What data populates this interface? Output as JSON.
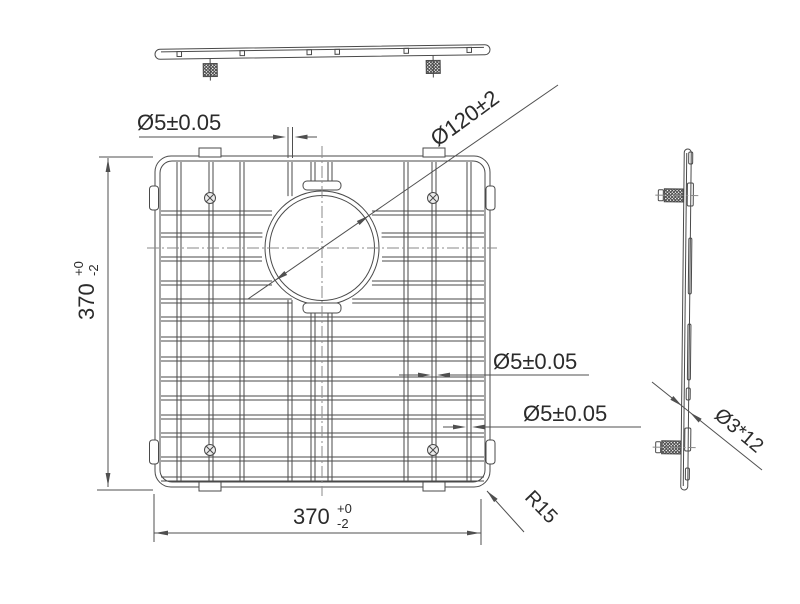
{
  "drawing": {
    "labels": {
      "dim_wire_top": "Ø5±0.05",
      "dim_circle": "Ø120±2",
      "dim_wire_mid": "Ø5±0.05",
      "dim_wire_bot": "Ø5±0.05",
      "dim_radius": "R15",
      "dim_side_stud": "Ø3*12",
      "dim_height": {
        "value": "370",
        "tol_plus": "+0",
        "tol_minus": "-2"
      },
      "dim_width": {
        "value": "370",
        "tol_plus": "+0",
        "tol_minus": "-2"
      }
    },
    "colors": {
      "ink": "#4a4a4a",
      "dim": "#4f4f4f",
      "center": "#8a8a8a",
      "screw_fill": "#ededed",
      "background": "#ffffff"
    },
    "geometry": {
      "front": {
        "frame_outer": [
          155,
          156,
          335,
          331,
          16
        ],
        "frame_inner": [
          160,
          161,
          325,
          321,
          12
        ],
        "wire_gap": 4,
        "h_wires": [
          211,
          233,
          257,
          281,
          299,
          317,
          337,
          357,
          377,
          396,
          415,
          433,
          457,
          477
        ],
        "h_span": [
          161,
          484
        ],
        "v_wires": [
          177,
          209,
          240,
          288,
          311,
          328,
          404,
          432,
          467
        ],
        "v_span": [
          162,
          481
        ],
        "circle": {
          "cx": 322,
          "cy": 248,
          "r_outer": 57,
          "r_inner": 52.5,
          "r_clip": 61
        },
        "ring_tabs": [
          [
            303,
            181,
            38,
            9,
            4
          ],
          [
            303,
            303,
            38,
            10,
            4
          ]
        ],
        "edge_tabs": [
          [
            199,
            148,
            22,
            9
          ],
          [
            423,
            148,
            22,
            9
          ],
          [
            199,
            482,
            22,
            9
          ],
          [
            423,
            482,
            22,
            9
          ]
        ],
        "bumpers": [
          [
            149.5,
            186,
            9,
            24,
            3
          ],
          [
            149.5,
            440,
            9,
            24,
            3
          ],
          [
            486,
            186,
            9,
            24,
            3
          ],
          [
            486,
            440,
            9,
            24,
            3
          ]
        ],
        "screws": {
          "pts": [
            [
              210,
              198
            ],
            [
              433,
              198
            ],
            [
              210,
              450
            ],
            [
              433,
              450
            ]
          ],
          "r": 5.5
        },
        "centerlines": [
          [
            147,
            248,
            497,
            248
          ],
          [
            322,
            146,
            322,
            496
          ]
        ]
      },
      "top_view": {
        "tilt": [
          -0.8,
          322,
          52
        ],
        "bar": [
          155,
          47,
          335,
          10,
          5
        ],
        "inner_line": [
          161,
          49.6,
          484,
          49.6
        ],
        "ticks": [
          177,
          240,
          307,
          335,
          404,
          467
        ],
        "legs": [
          210,
          433
        ],
        "leg_pin_y": [
          57,
          79
        ],
        "foot": {
          "dx": -7,
          "y": 62,
          "w": 14,
          "h": 13
        }
      },
      "side_view": {
        "tilt": [
          0.6,
          686,
          320
        ],
        "bar": [
          682.5,
          149,
          7,
          341,
          3.5
        ],
        "inner_line": [
          685,
          153,
          685,
          486
        ],
        "bumps": [
          [
            687,
            152,
            4,
            12
          ],
          [
            686,
            183,
            6,
            23
          ],
          [
            688,
            238,
            3,
            56
          ],
          [
            688,
            324,
            3,
            56
          ],
          [
            687,
            388,
            4,
            12
          ],
          [
            686,
            428,
            6,
            23
          ],
          [
            687,
            468,
            4,
            12
          ]
        ],
        "feet": [
          [
            663,
            189,
            19,
            13
          ],
          [
            663,
            441,
            19,
            13
          ]
        ],
        "caps": [
          [
            657,
            190,
            5,
            11
          ],
          [
            657,
            442,
            5,
            11
          ]
        ],
        "pins": [
          [
            654,
            195.5,
            697,
            195.5
          ],
          [
            654,
            447.5,
            697,
            447.5
          ]
        ]
      },
      "dims": {
        "lines": [
          [
            139,
            137,
            274,
            137
          ],
          [
            307,
            137,
            317,
            137
          ],
          [
            288,
            127,
            288,
            158
          ],
          [
            292.5,
            127,
            292.5,
            158
          ],
          [
            248,
            299,
            558,
            85
          ],
          [
            108,
            158,
            108,
            487
          ],
          [
            99,
            157,
            153,
            157
          ],
          [
            97,
            490,
            153,
            490
          ],
          [
            399,
            375,
            418,
            375
          ],
          [
            450,
            375,
            589,
            375
          ],
          [
            443,
            427,
            453,
            427
          ],
          [
            485,
            427,
            641,
            427
          ],
          [
            487,
            491,
            524,
            532
          ],
          [
            154,
            533,
            481,
            533
          ],
          [
            154,
            494,
            154,
            542
          ],
          [
            481,
            499,
            481,
            545
          ],
          [
            652,
            382,
            762,
            470
          ]
        ],
        "arrows": [
          [
            286,
            137,
            0
          ],
          [
            294.5,
            137,
            180
          ],
          [
            368.9,
            215.6,
            -34.7
          ],
          [
            275.1,
            280.4,
            145.3
          ],
          [
            108,
            159,
            -90
          ],
          [
            108,
            486,
            90
          ],
          [
            431,
            375,
            0
          ],
          [
            437,
            375,
            180
          ],
          [
            466,
            427,
            0
          ],
          [
            472,
            427,
            180
          ],
          [
            487,
            491,
            -133
          ],
          [
            155,
            533,
            180
          ],
          [
            480,
            533,
            0
          ],
          [
            682,
            406,
            38.7
          ],
          [
            690,
            412.5,
            -141.3
          ]
        ]
      }
    }
  }
}
